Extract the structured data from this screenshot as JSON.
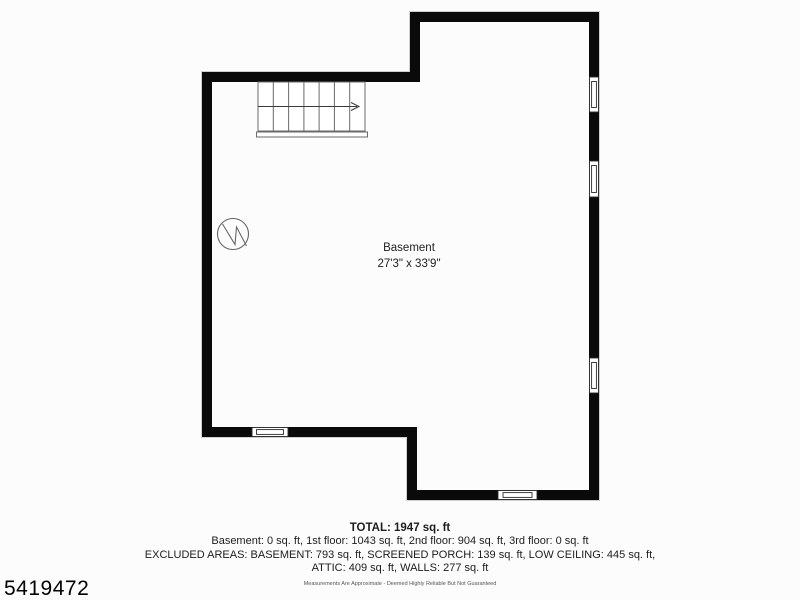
{
  "page": {
    "listing_id": "5419472",
    "disclaimer": "Measurements Are Approximate - Deemed Highly Reliable But Not Guaranteed",
    "background_color": "#fcfcfc"
  },
  "floor_plan": {
    "room": {
      "name": "Basement",
      "dimensions": "27'3\" x 33'9\""
    },
    "symbols": [
      "staircase-symbol",
      "stair-direction-arrow",
      "utility-fixture-symbol",
      "window-symbol-right-1",
      "window-symbol-right-2",
      "window-symbol-right-3",
      "window-symbol-bottom-left",
      "window-symbol-bottom-right"
    ],
    "colors": {
      "wall": "#0a0a0a",
      "stair_lines": "#6a6a6a",
      "symbol_lines": "#666666",
      "window_frame": "#2a2a2a",
      "outer_halo": "#d0d0d0"
    }
  },
  "summary": {
    "total": "TOTAL: 1947 sq. ft",
    "lines": [
      "Basement: 0 sq. ft, 1st floor: 1043 sq. ft, 2nd floor: 904 sq. ft, 3rd floor: 0 sq. ft",
      "EXCLUDED AREAS: BASEMENT: 793 sq. ft, SCREENED PORCH: 139 sq. ft, LOW CEILING: 445 sq. ft,",
      "ATTIC: 409 sq. ft, WALLS: 277 sq. ft"
    ]
  }
}
